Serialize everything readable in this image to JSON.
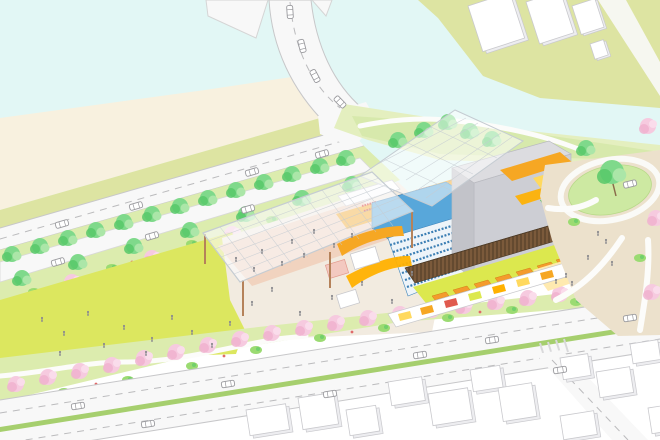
{
  "scene_elements": {
    "description_note": "axonometric architectural site rendering, no visible text",
    "items": [
      "river",
      "sand-bank",
      "bridge-road",
      "waterfront-road",
      "street-trees",
      "pedestrian-path",
      "large-lawn",
      "event-canopy",
      "cultural-building-cutaway",
      "theater-auditorium",
      "fly-tower",
      "market-hall",
      "roof-glass-canopy",
      "east-garden-plaza",
      "cherry-tree-band",
      "boulevard",
      "side-street",
      "white-city-blocks",
      "canal",
      "far-bank-buildings",
      "cars",
      "people"
    ]
  },
  "colors": {
    "water": "#e2f7f5",
    "sand": "#f8f1df",
    "bank_olive": "#dde4a2",
    "road": "#f8f8f8",
    "road_edge": "#c7c7c9",
    "road_dash": "#bbbbbd",
    "grass_strip": "#dcecae",
    "lawn": "#dce75f",
    "plaza": "#f2ebe0",
    "terracotta": "#f1d3bf",
    "slope_green": "#e4efbf",
    "slope_green2": "#d2e7a4",
    "median_green": "#a6cf6e",
    "tree_green": "#7fd98b",
    "tree_green_dark": "#57c868",
    "tree_green_light": "#abe6a8",
    "tree_pink": "#f6cadf",
    "tree_pink_dark": "#f0b2cf",
    "bush_green": "#9bdb72",
    "flower_red": "#e06a6a",
    "bldg_white": "#ffffff",
    "bldg_edge": "#c9c9cd",
    "bldg_side": "#ededf0",
    "glass_edge": "#c5ccd2",
    "orange": "#f6a723",
    "orange_bright": "#ffb100",
    "yellow": "#ffd95e",
    "yellow_pale": "#ffeab0",
    "market_floor": "#dce84e",
    "stall_orange": "#f49b2d",
    "blue_wall": "#58a7da",
    "blue_deep": "#3f85bb",
    "seat_row": "#3c7fb4",
    "gray_top": "#dcdce0",
    "gray_front": "#cdced4",
    "gray_side": "#c2c3c9",
    "wood": "#7b5a3b",
    "wood_dark": "#4c3a26",
    "red_seat": "#d42020",
    "people": "#8b8b8f",
    "car_edge": "#9a9a9e",
    "path_white": "#fcfcfa",
    "column_wood": "#b5825a"
  }
}
